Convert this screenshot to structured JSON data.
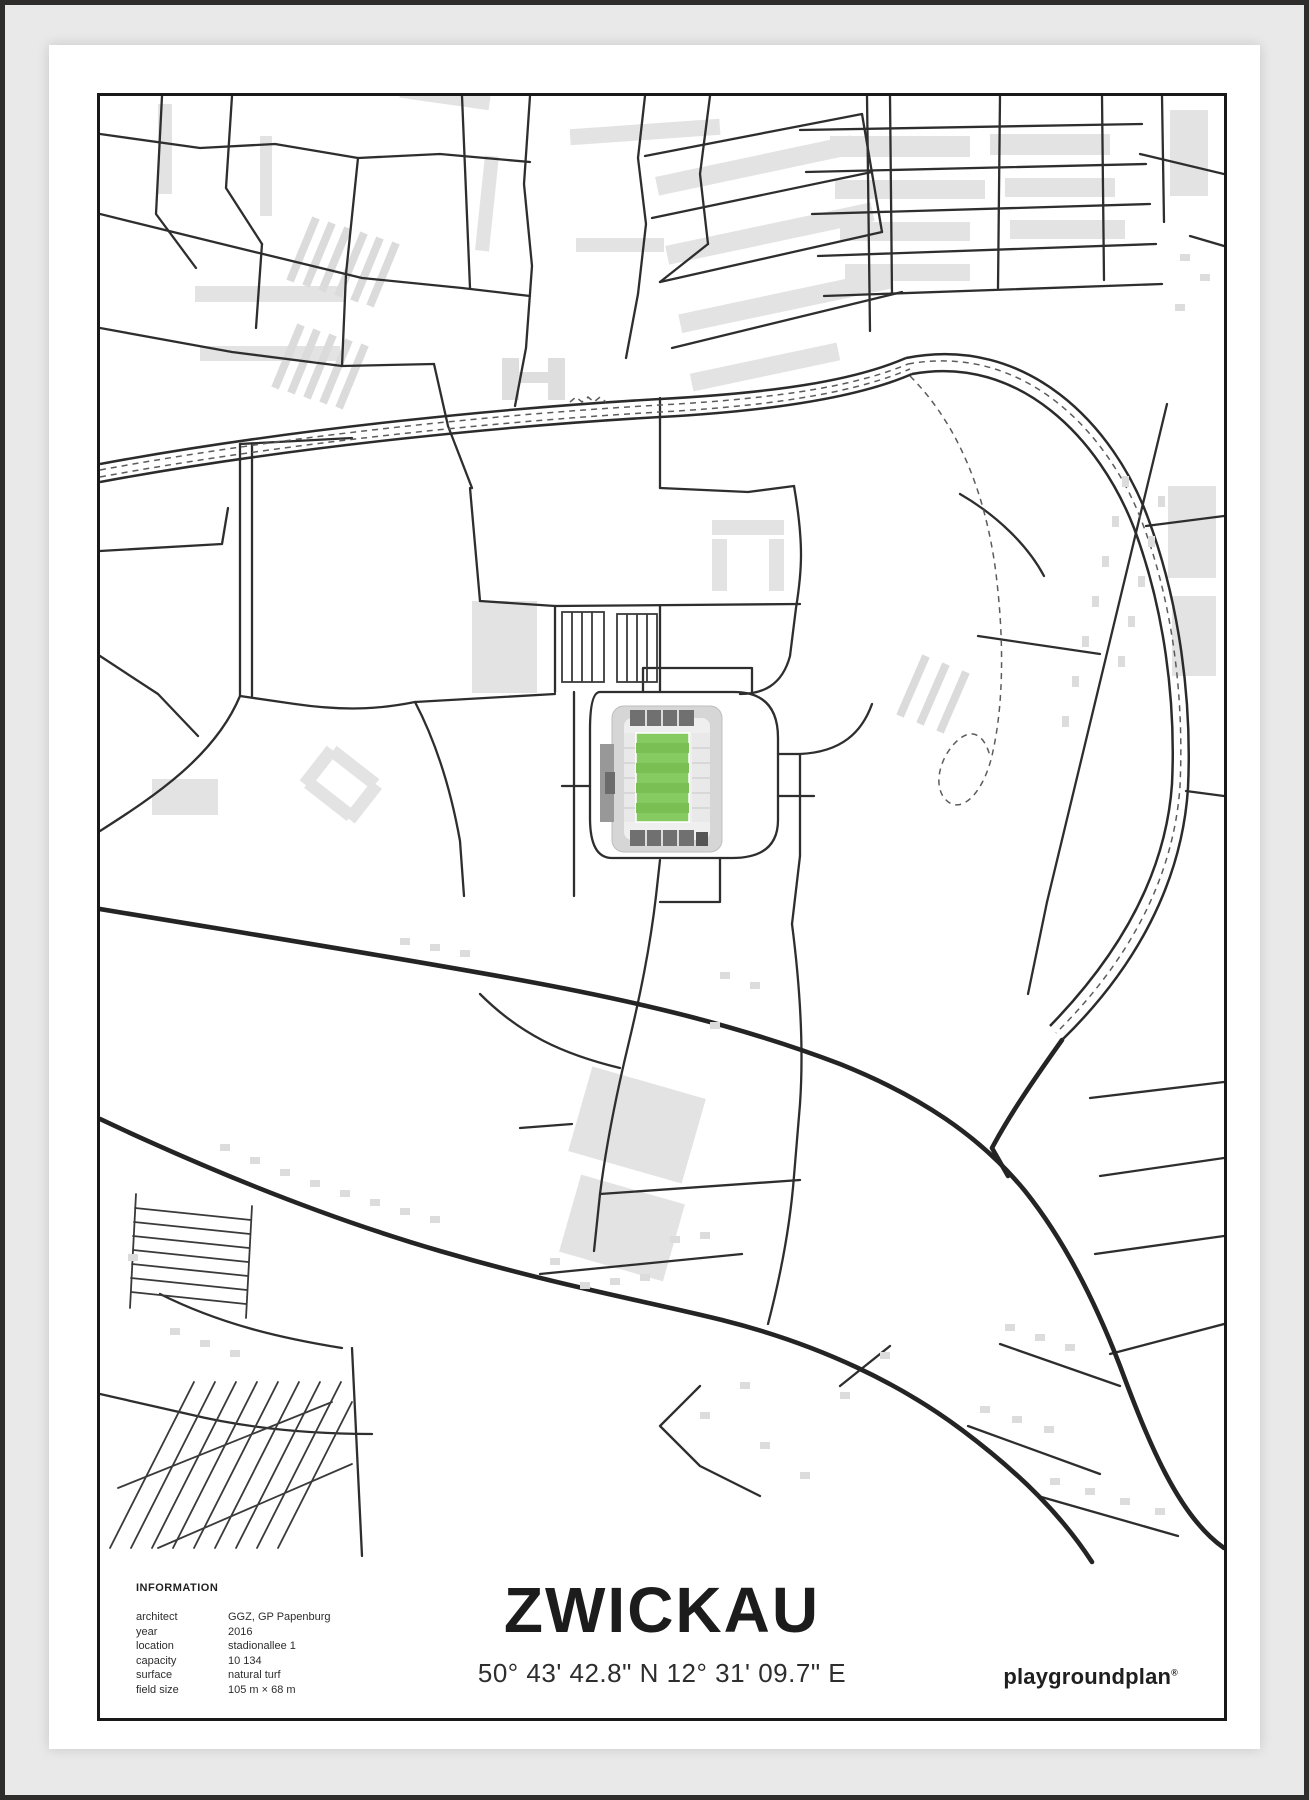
{
  "poster": {
    "caption": {
      "information": {
        "heading": "INFORMATION",
        "rows": [
          {
            "label": "architect",
            "value": "GGZ, GP Papenburg"
          },
          {
            "label": "year",
            "value": "2016"
          },
          {
            "label": "location",
            "value": "stadionallee 1"
          },
          {
            "label": "capacity",
            "value": "10 134"
          },
          {
            "label": "surface",
            "value": "natural turf"
          },
          {
            "label": "field size",
            "value": "105 m × 68 m"
          }
        ]
      },
      "title": "ZWICKAU",
      "coordinates": "50° 43' 42.8\" N 12° 31' 09.7\" E",
      "brand": {
        "name": "playgroundplan",
        "registered_mark": "®"
      }
    },
    "map": {
      "colors": {
        "street": "#2e2e2e",
        "main_road": "#242424",
        "railway_dash": "#5c5c5c",
        "building": "#e3e3e3",
        "background": "#ffffff",
        "border": "#191919",
        "frame": "#e9e9e9",
        "pitch_green": "#86ca62",
        "pitch_stripe_green": "#79bf53",
        "stand_gray": "#d6d6d6",
        "dark_stand_gray": "#707070"
      }
    }
  }
}
